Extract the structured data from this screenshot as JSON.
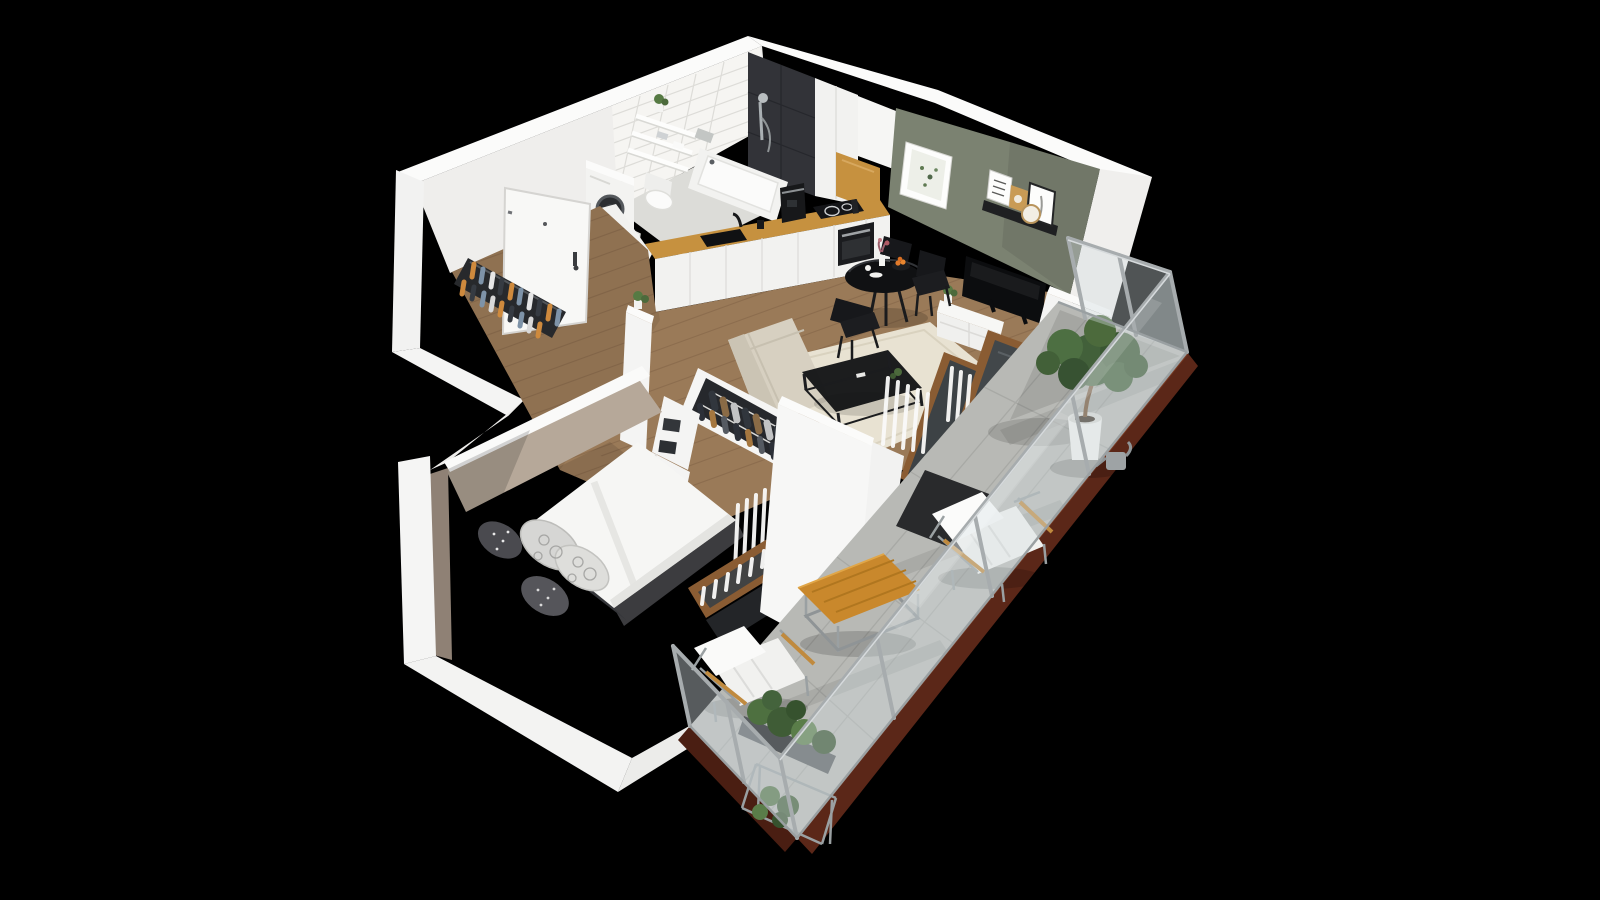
{
  "scene": {
    "type": "3d-floorplan-cutaway-render",
    "view": "isometric-birdseye",
    "background": "#000000",
    "palette": {
      "wall_top_white": "#fbfbfa",
      "wall_white": "#efeeec",
      "accent_wall_green": "#7b8271",
      "bedroom_wall_taupe": "#b6a899",
      "tile_white": "#f6f5f2",
      "shower_tile_dark": "#323338",
      "floor_wood": "#9a7a58",
      "balcony_floor": "#b8b9b5",
      "balcony_fascia": "#5b2718",
      "rug_cream": "#e8e2d2",
      "counter_oak": "#c6913f",
      "door_wood": "#8a5c33",
      "furniture_black": "#111214",
      "chair_black": "#17181b",
      "sofa_beige": "#d7d0c1",
      "bedding_white": "#f6f6f4",
      "curtain_white": "#fafaf9",
      "railing_grey": "#a7acae",
      "glass": "rgba(210,220,223,0.38)",
      "outdoor_table_teak": "#c9882c",
      "plant_green": "#4c6a3c",
      "clothes_orange": "#cf8a3d",
      "clothes_blue": "#7e93a8"
    },
    "rooms": [
      {
        "name": "entry-hall",
        "floor": "wood-planks",
        "features": [
          "entrance-door",
          "coat-rack-with-clothes",
          "open-bathroom-door"
        ]
      },
      {
        "name": "bathroom",
        "floor": "grey-tile",
        "features": [
          "white-subway-tile-wall",
          "dark-shower-tile-wall",
          "bathtub",
          "shower-fixture",
          "wall-hung-toilet",
          "washing-machine",
          "wall-shelves",
          "towels",
          "plant",
          "laundry-mat"
        ]
      },
      {
        "name": "kitchen",
        "floor": "wood-planks",
        "features": [
          "white-base-cabinets",
          "oak-countertop",
          "black-sink",
          "faucet",
          "coffee-machine",
          "induction-cooktop",
          "built-in-oven",
          "tall-cabinet",
          "upper-cabinet-oak-front"
        ]
      },
      {
        "name": "living-dining",
        "floor": "wood-planks",
        "features": [
          "green-accent-wall",
          "framed-botanical-art",
          "picture-ledge-with-three-frames",
          "round-mirror",
          "tv",
          "tv-console",
          "round-dining-table",
          "dining-chairs",
          "flower-vase",
          "fruit-bowl",
          "cream-rug",
          "black-coffee-table",
          "beige-sofa",
          "half-wall-plant",
          "balcony-door",
          "white-curtains"
        ]
      },
      {
        "name": "bedroom",
        "floor": "wood-planks",
        "features": [
          "taupe-accent-walls",
          "double-bed-white-duvet",
          "patterned-pillows",
          "open-wardrobe-with-clothes",
          "white-shelving-unit",
          "storage-boxes",
          "window-wood-frame",
          "white-curtains"
        ]
      },
      {
        "name": "balcony",
        "floor": "concrete-tiles",
        "features": [
          "glass-railing",
          "maroon-fascia",
          "potted-tree",
          "watering-can",
          "two-lounge-chairs",
          "teak-coffee-table",
          "railing-planter",
          "floor-plants",
          "door-mat"
        ]
      }
    ],
    "counts": {
      "dining_chairs": 3,
      "balcony_lounge_chairs": 2,
      "ledge_frames": 3,
      "large_wall_frames": 1,
      "bed_pillows": 4,
      "wall_shelves": 3,
      "balcony_plants": 3
    }
  }
}
